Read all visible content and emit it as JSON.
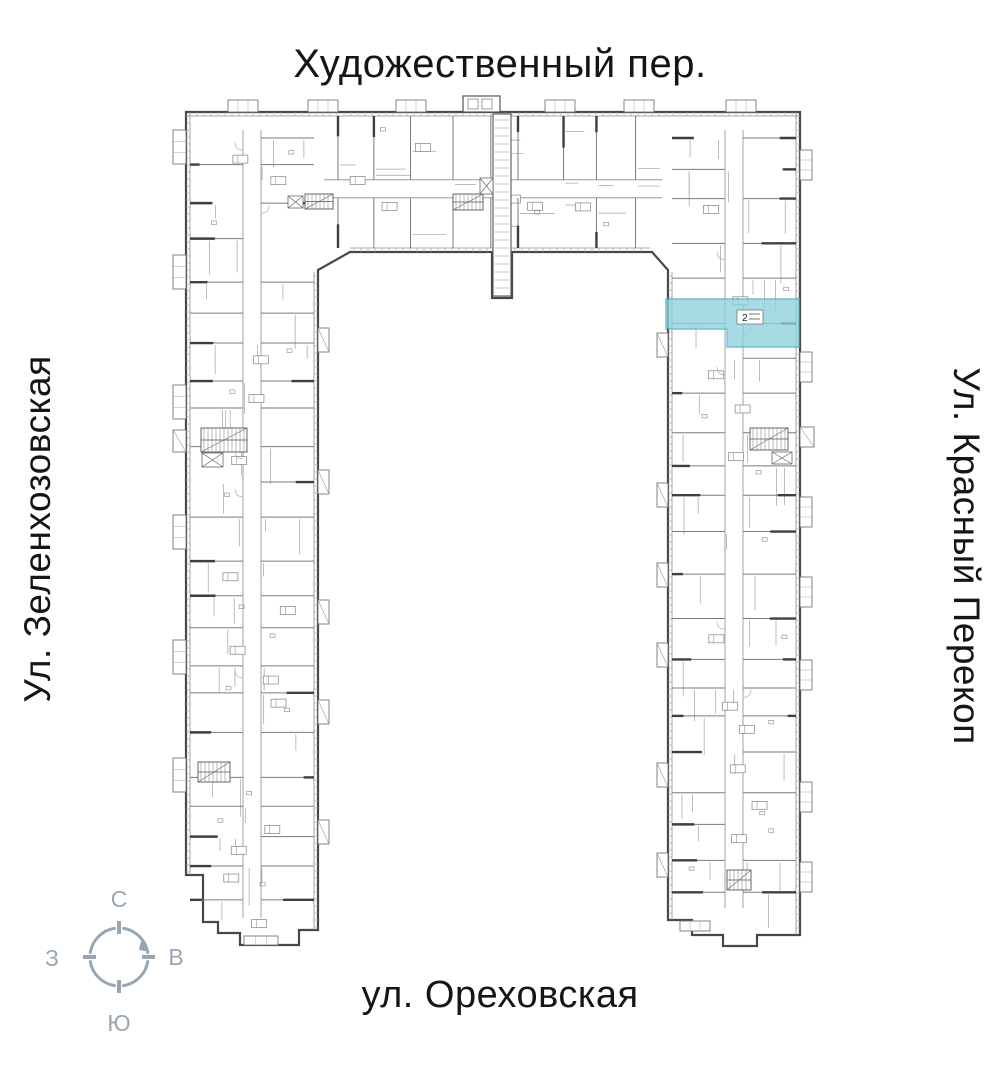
{
  "streets": {
    "top": "Художественный пер.",
    "left": "Ул. Зеленхозовская",
    "right": "Ул. Красный Перекоп",
    "bottom": "ул. Ореховская"
  },
  "compass": {
    "north": "С",
    "south": "Ю",
    "west": "З",
    "east": "В",
    "color": "#98A6B4"
  },
  "plan": {
    "highlight": {
      "color": "#8FD2DC",
      "border": "#4FAEC2",
      "unit_rooms": "2"
    },
    "wall_color": "#474747",
    "line_color": "#7a7a7a",
    "light_line_color": "#a0a0a0"
  }
}
